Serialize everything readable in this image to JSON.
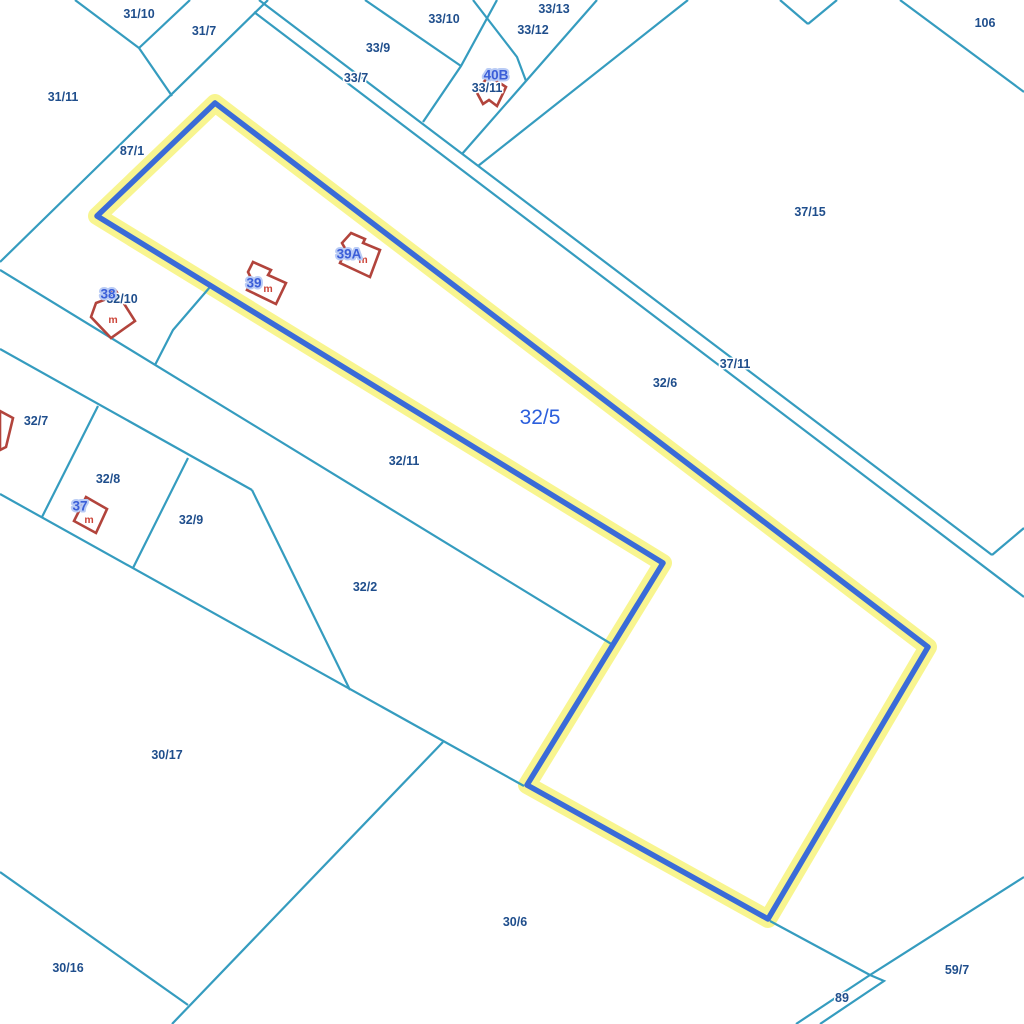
{
  "map": {
    "width": 1024,
    "height": 1024,
    "background": "#FFFFFF",
    "colors": {
      "parcel_line": "#359CBF",
      "parcel_label": "#1F4E8C",
      "selected_halo": "#F8F48A",
      "selected_line": "#3A6BD8",
      "selected_label_color": "#2C5FDC",
      "building_line": "#B2443C",
      "building_fill": "#FFFFFF",
      "house_label": "#3B5ED8",
      "house_label_halo": "#B9CBF5",
      "material_label": "#CC4438",
      "label_halo": "#FFFFFF"
    },
    "selected_parcel": {
      "id": "32/5",
      "points": [
        [
          215,
          103
        ],
        [
          97,
          216
        ],
        [
          663,
          563
        ],
        [
          527,
          785
        ],
        [
          768,
          919
        ],
        [
          928,
          647
        ]
      ],
      "label": {
        "text": "32/5",
        "x": 540,
        "y": 417
      }
    },
    "boundary_lines": [
      {
        "points": [
          [
            75,
            0
          ],
          [
            139,
            48
          ]
        ]
      },
      {
        "points": [
          [
            190,
            0
          ],
          [
            139,
            48
          ]
        ]
      },
      {
        "points": [
          [
            139,
            48
          ],
          [
            172,
            96
          ]
        ]
      },
      {
        "points": [
          [
            268,
            0
          ],
          [
            0,
            262
          ]
        ]
      },
      {
        "points": [
          [
            259,
            0
          ],
          [
            992,
            555
          ]
        ]
      },
      {
        "points": [
          [
            254,
            12
          ],
          [
            1024,
            597
          ]
        ]
      },
      {
        "points": [
          [
            473,
            0
          ],
          [
            517,
            57
          ],
          [
            526,
            81
          ]
        ]
      },
      {
        "points": [
          [
            597,
            0
          ],
          [
            462,
            154
          ]
        ]
      },
      {
        "points": [
          [
            688,
            0
          ],
          [
            478,
            166
          ]
        ]
      },
      {
        "points": [
          [
            365,
            0
          ],
          [
            461,
            66
          ]
        ]
      },
      {
        "points": [
          [
            497,
            0
          ],
          [
            461,
            66
          ],
          [
            423,
            122
          ]
        ]
      },
      {
        "points": [
          [
            900,
            0
          ],
          [
            1024,
            92
          ]
        ]
      },
      {
        "points": [
          [
            780,
            0
          ],
          [
            808,
            24
          ]
        ]
      },
      {
        "points": [
          [
            837,
            0
          ],
          [
            808,
            24
          ]
        ]
      },
      {
        "points": [
          [
            992,
            555
          ],
          [
            1024,
            528
          ]
        ]
      },
      {
        "points": [
          [
            0,
            270
          ],
          [
            613,
            645
          ]
        ]
      },
      {
        "points": [
          [
            0,
            349
          ],
          [
            252,
            490
          ]
        ]
      },
      {
        "points": [
          [
            98,
            406
          ],
          [
            42,
            517
          ]
        ]
      },
      {
        "points": [
          [
            188,
            458
          ],
          [
            133,
            568
          ]
        ]
      },
      {
        "points": [
          [
            252,
            490
          ],
          [
            350,
            690
          ]
        ]
      },
      {
        "points": [
          [
            0,
            494
          ],
          [
            524,
            786
          ]
        ]
      },
      {
        "points": [
          [
            443,
            742
          ],
          [
            172,
            1024
          ]
        ]
      },
      {
        "points": [
          [
            0,
            872
          ],
          [
            188,
            1005
          ]
        ]
      },
      {
        "points": [
          [
            770,
            921
          ],
          [
            870,
            975
          ]
        ]
      },
      {
        "points": [
          [
            1024,
            877
          ],
          [
            870,
            975
          ],
          [
            796,
            1024
          ]
        ]
      },
      {
        "points": [
          [
            870,
            975
          ],
          [
            884,
            981
          ],
          [
            820,
            1024
          ]
        ]
      },
      {
        "points": [
          [
            210,
            287
          ],
          [
            173,
            330
          ],
          [
            155,
            365
          ]
        ]
      }
    ],
    "parcel_labels": [
      {
        "text": "31/10",
        "x": 139,
        "y": 14
      },
      {
        "text": "31/7",
        "x": 204,
        "y": 31
      },
      {
        "text": "33/10",
        "x": 444,
        "y": 19
      },
      {
        "text": "33/13",
        "x": 554,
        "y": 9
      },
      {
        "text": "33/12",
        "x": 533,
        "y": 30
      },
      {
        "text": "33/9",
        "x": 378,
        "y": 48
      },
      {
        "text": "33/7",
        "x": 356,
        "y": 78
      },
      {
        "text": "33/11",
        "x": 487,
        "y": 88
      },
      {
        "text": "106",
        "x": 985,
        "y": 23
      },
      {
        "text": "31/11",
        "x": 63,
        "y": 97
      },
      {
        "text": "87/1",
        "x": 132,
        "y": 151
      },
      {
        "text": "37/15",
        "x": 810,
        "y": 212
      },
      {
        "text": "32/10",
        "x": 122,
        "y": 299
      },
      {
        "text": "37/11",
        "x": 735,
        "y": 364
      },
      {
        "text": "32/6",
        "x": 665,
        "y": 383
      },
      {
        "text": "32/7",
        "x": 36,
        "y": 421
      },
      {
        "text": "32/11",
        "x": 404,
        "y": 461
      },
      {
        "text": "32/8",
        "x": 108,
        "y": 479
      },
      {
        "text": "32/9",
        "x": 191,
        "y": 520
      },
      {
        "text": "32/2",
        "x": 365,
        "y": 587
      },
      {
        "text": "30/17",
        "x": 167,
        "y": 755
      },
      {
        "text": "30/16",
        "x": 68,
        "y": 968
      },
      {
        "text": "30/6",
        "x": 515,
        "y": 922
      },
      {
        "text": "59/7",
        "x": 957,
        "y": 970
      },
      {
        "text": "89",
        "x": 842,
        "y": 998
      }
    ],
    "buildings": [
      {
        "id": "40B",
        "points": [
          [
            489,
            76
          ],
          [
            506,
            87
          ],
          [
            497,
            106
          ],
          [
            489,
            100
          ],
          [
            483,
            104
          ],
          [
            476,
            91
          ]
        ],
        "label": {
          "text": "40B",
          "x": 496,
          "y": 75
        },
        "material": null
      },
      {
        "id": "39A",
        "points": [
          [
            351,
            233
          ],
          [
            365,
            239
          ],
          [
            363,
            243
          ],
          [
            380,
            250
          ],
          [
            370,
            277
          ],
          [
            340,
            263
          ],
          [
            346,
            250
          ],
          [
            342,
            243
          ]
        ],
        "label": {
          "text": "39A",
          "x": 349,
          "y": 254
        },
        "material": {
          "text": "m",
          "x": 363,
          "y": 259
        }
      },
      {
        "id": "39",
        "points": [
          [
            253,
            262
          ],
          [
            271,
            270
          ],
          [
            268,
            275
          ],
          [
            286,
            283
          ],
          [
            276,
            304
          ],
          [
            247,
            290
          ],
          [
            252,
            280
          ],
          [
            248,
            272
          ]
        ],
        "label": {
          "text": "39",
          "x": 254,
          "y": 283
        },
        "material": {
          "text": "m",
          "x": 268,
          "y": 288
        }
      },
      {
        "id": "38",
        "points": [
          [
            96,
            303
          ],
          [
            104,
            300
          ],
          [
            102,
            295
          ],
          [
            116,
            291
          ],
          [
            135,
            321
          ],
          [
            111,
            338
          ],
          [
            91,
            317
          ]
        ],
        "label": {
          "text": "38",
          "x": 108,
          "y": 294
        },
        "material": {
          "text": "m",
          "x": 113,
          "y": 319
        }
      },
      {
        "id": "37",
        "points": [
          [
            86,
            497
          ],
          [
            107,
            509
          ],
          [
            96,
            533
          ],
          [
            74,
            521
          ]
        ],
        "label": {
          "text": "37",
          "x": 80,
          "y": 506
        },
        "material": {
          "text": "m",
          "x": 89,
          "y": 519
        }
      },
      {
        "id": "edge-fragment",
        "points": [
          [
            0,
            411
          ],
          [
            13,
            418
          ],
          [
            6,
            447
          ],
          [
            0,
            450
          ]
        ],
        "label": null,
        "material": null
      }
    ]
  }
}
